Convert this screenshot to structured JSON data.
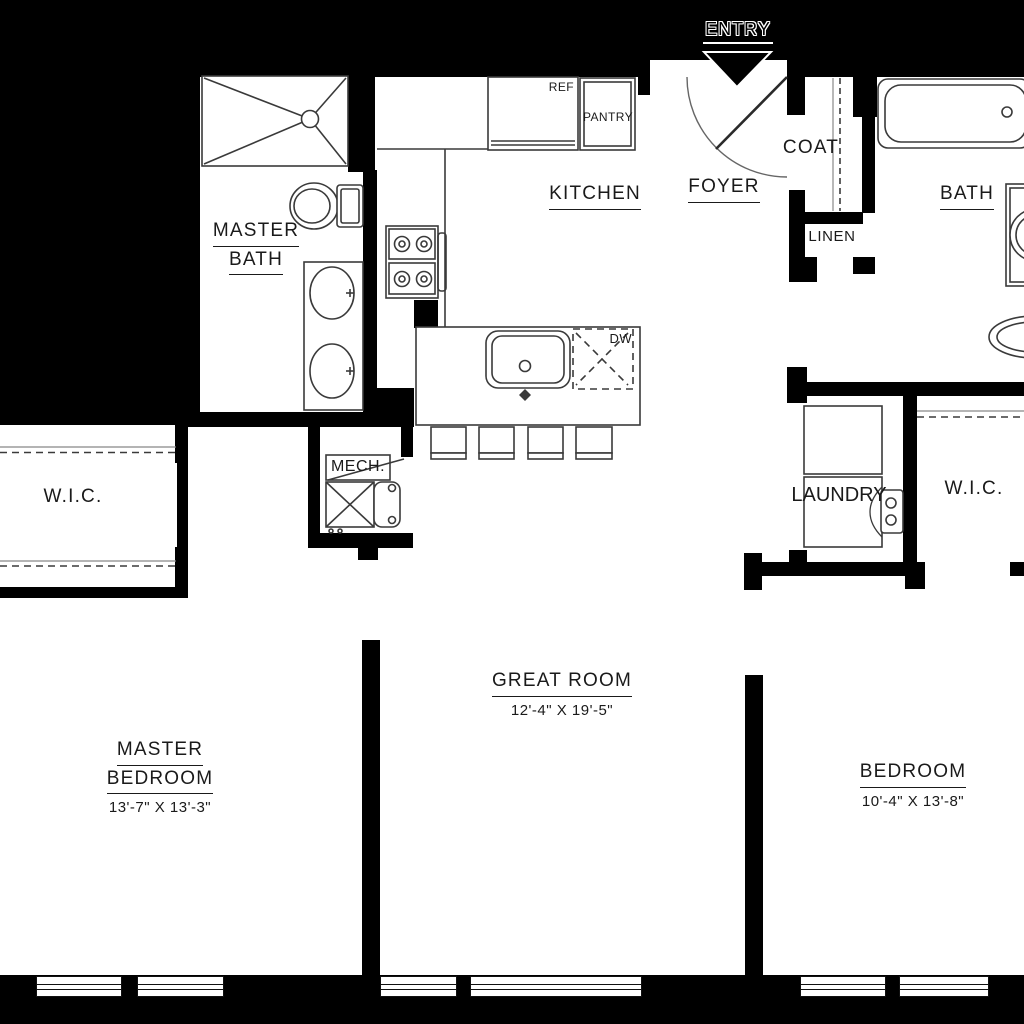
{
  "colors": {
    "background": "#000000",
    "floor": "#ffffff",
    "wall": "#000000",
    "fixture_line": "#3a3a3a",
    "text": "#1a1a1a"
  },
  "entry": {
    "label": "ENTRY"
  },
  "rooms": {
    "master_bath": {
      "line1": "MASTER",
      "line2": "BATH"
    },
    "kitchen": {
      "label": "KITCHEN"
    },
    "foyer": {
      "label": "FOYER"
    },
    "coat": {
      "label": "COAT"
    },
    "linen": {
      "label": "LINEN"
    },
    "bath": {
      "label": "BATH"
    },
    "mech": {
      "label": "MECH."
    },
    "laundry": {
      "label": "LAUNDRY"
    },
    "wic_left": {
      "label": "W.I.C."
    },
    "wic_right": {
      "label": "W.I.C."
    },
    "great_room": {
      "label": "GREAT ROOM",
      "dimensions": "12'-4\" X 19'-5\""
    },
    "master_bedroom": {
      "line1": "MASTER",
      "line2": "BEDROOM",
      "dimensions": "13'-7\" X 13'-3\""
    },
    "bedroom": {
      "label": "BEDROOM",
      "dimensions": "10'-4\" X 13'-8\""
    }
  },
  "fixtures": {
    "refrigerator": "REF",
    "pantry": "PANTRY",
    "dishwasher": "DW"
  }
}
